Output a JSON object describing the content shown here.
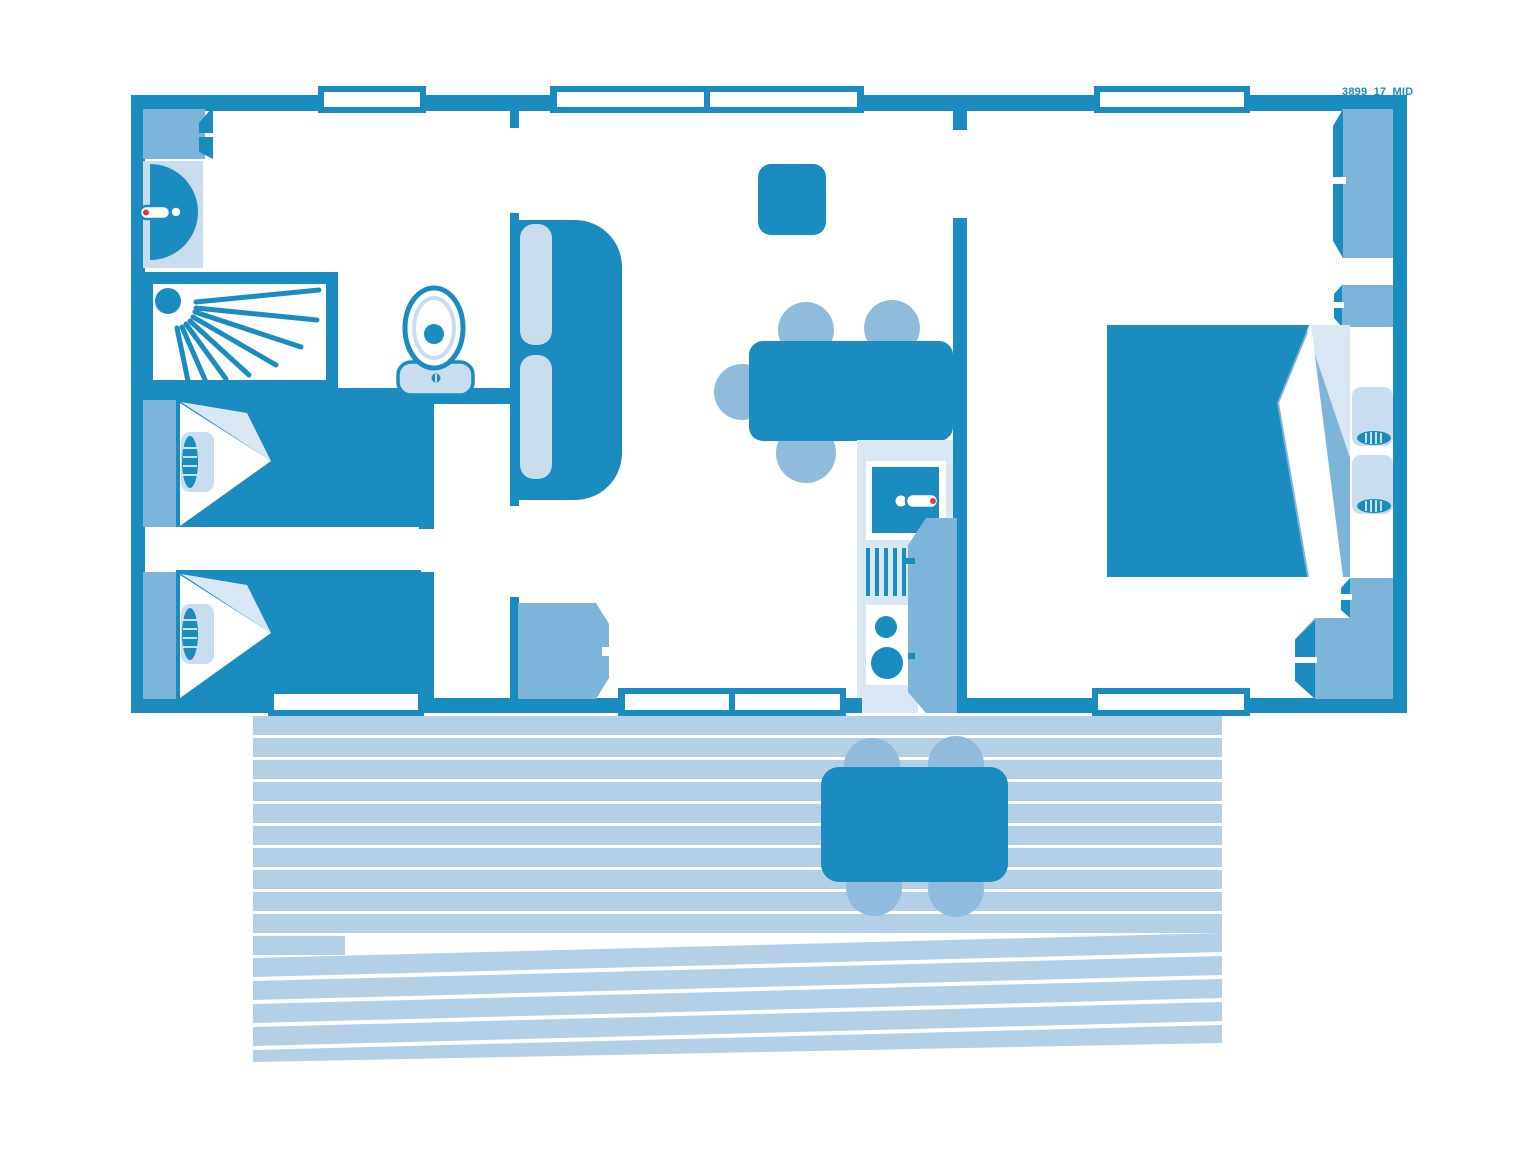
{
  "meta": {
    "plan_label": "3899_17_MID"
  },
  "colors": {
    "dark": "#1b8cc0",
    "medium": "#7cb5d9",
    "chair": "#8fbbdc",
    "light": "#c9ddef",
    "xlight": "#d9e6f3",
    "deck": "#b3d0e6",
    "red": "#e23c38",
    "background": "#ffffff"
  },
  "areas": {
    "bathroom": "bathroom-with-shower-sink-wc",
    "bedroom_twin": "bedroom-two-single-beds",
    "living": "living-dining-area",
    "kitchen": "kitchenette",
    "bedroom_master": "bedroom-double-bed",
    "deck": "outdoor-deck-terrace"
  }
}
